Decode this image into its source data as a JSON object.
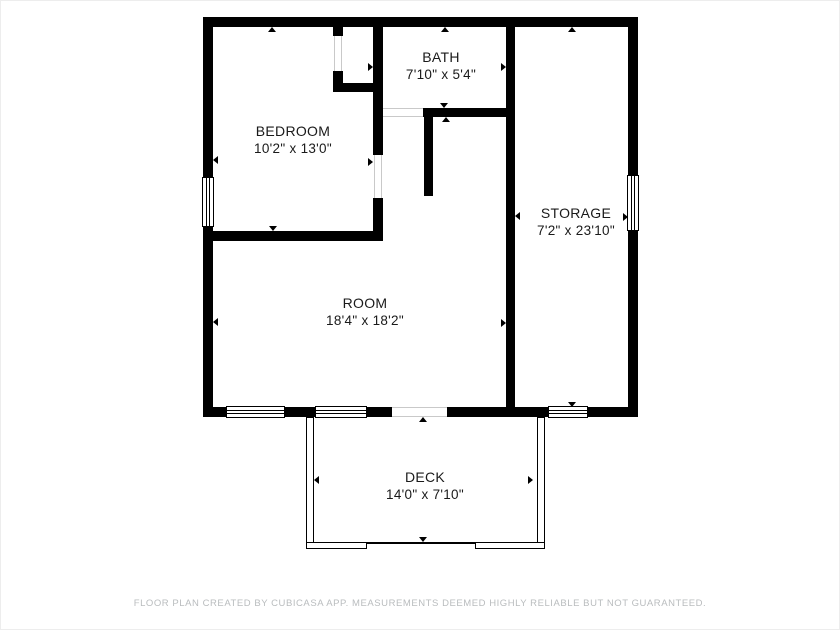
{
  "colors": {
    "background": "#ffffff",
    "wall": "#000000",
    "label_text": "#1a1a1a",
    "footer_text": "#b9bcbe"
  },
  "rooms": {
    "bath": {
      "name": "BATH",
      "dimensions": "7'10\" x 5'4\""
    },
    "bedroom": {
      "name": "BEDROOM",
      "dimensions": "10'2\" x 13'0\""
    },
    "storage": {
      "name": "STORAGE",
      "dimensions": "7'2\" x 23'10\""
    },
    "room": {
      "name": "ROOM",
      "dimensions": "18'4\" x 18'2\""
    },
    "deck": {
      "name": "DECK",
      "dimensions": "14'0\" x 7'10\""
    }
  },
  "footer": {
    "disclaimer": "FLOOR PLAN CREATED BY CUBICASA APP. MEASUREMENTS DEEMED HIGHLY RELIABLE BUT NOT GUARANTEED."
  }
}
